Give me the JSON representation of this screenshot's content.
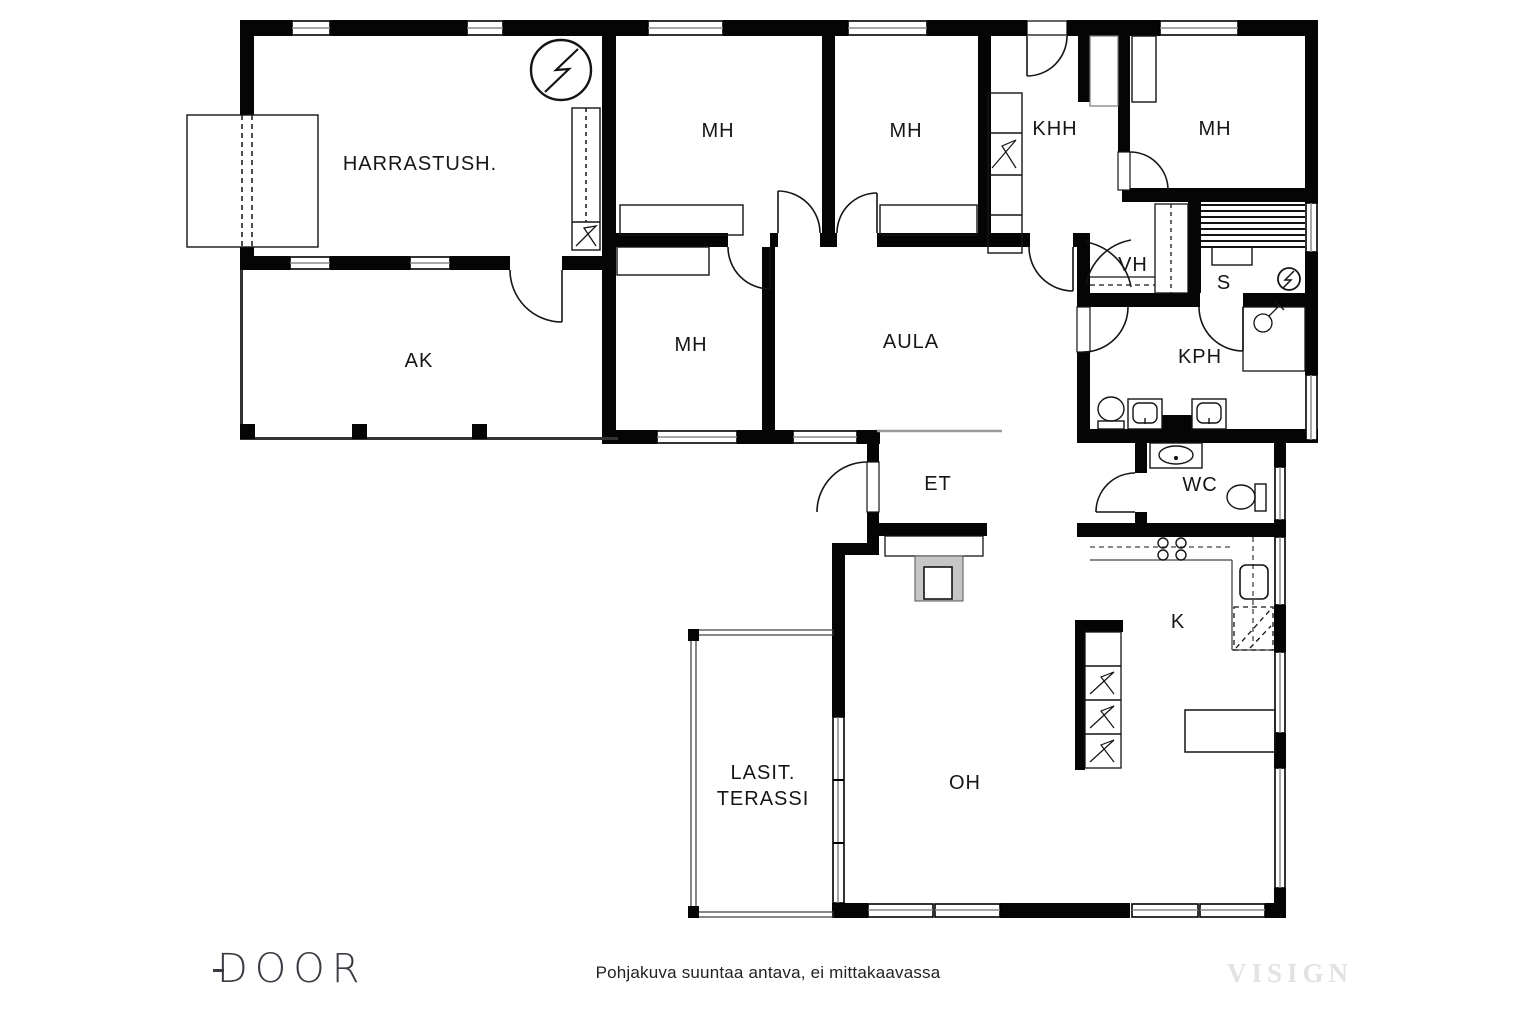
{
  "title": "Pohjakuva",
  "rooms": {
    "harrastush": "HARRASTUSH.",
    "mh1": "MH",
    "mh2": "MH",
    "mh3": "MH",
    "mh4": "MH",
    "khh": "KHH",
    "vh": "VH",
    "s": "S",
    "ak": "AK",
    "aula": "AULA",
    "kph": "KPH",
    "et": "ET",
    "wc": "WC",
    "k": "K",
    "oh": "OH",
    "terassi_line1": "LASIT.",
    "terassi_line2": "TERASSI"
  },
  "footer": {
    "disclaimer": "Pohjakuva suuntaa antava, ei mittakaavassa",
    "logo": "DOOR",
    "watermark": "VISIGN"
  },
  "icons": {
    "electrical-center-icon": "circle-lightning",
    "sauna-stove-icon": "circle-lightning-small",
    "shower-mixer-icon": "circle-with-arm",
    "toilet-icon": "bowl-with-tank",
    "sink-icon": "basin-rect",
    "stove-icon": "four-burner-circles",
    "dishwasher-icon": "dashed-square",
    "flue-icon": "zigzag-cell"
  },
  "colors": {
    "wall": "#050505",
    "line": "#141414",
    "thin": "#555555",
    "fireplace": "#c6c6c6",
    "watermark": "#e2e2e2",
    "footer": "#222222"
  }
}
